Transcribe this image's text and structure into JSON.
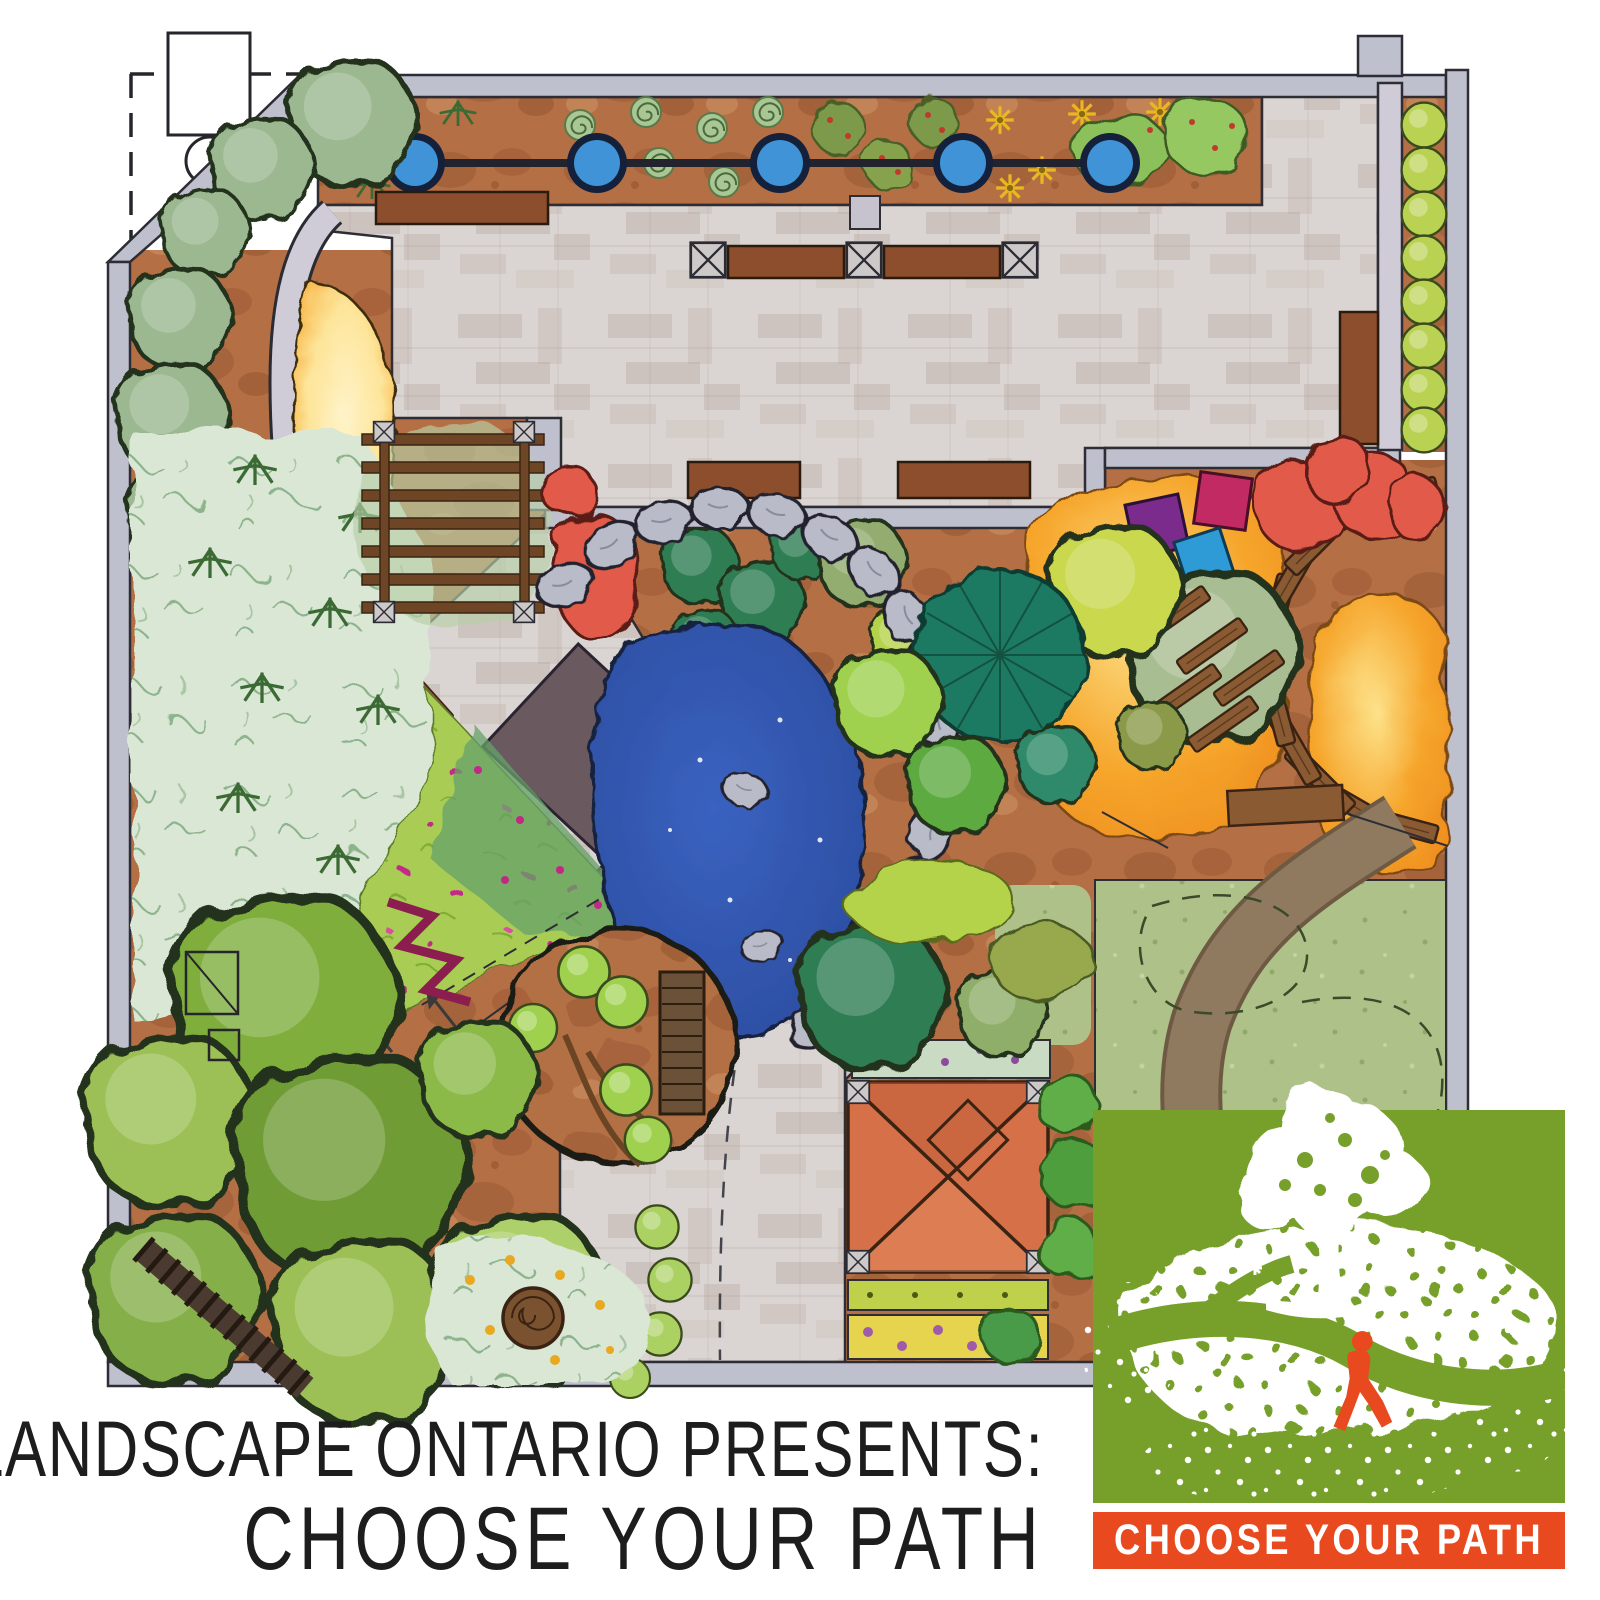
{
  "page": {
    "background": "#ffffff"
  },
  "caption": {
    "line1": "LANDSCAPE ONTARIO PRESENTS:",
    "line2": "CHOOSE YOUR PATH"
  },
  "logo": {
    "label": "CHOOSE YOUR PATH",
    "green": "#76a02a",
    "orange": "#e8491f",
    "white": "#ffffff",
    "tree_icon": "oak-tree",
    "figure_icon": "walking-person"
  },
  "plan": {
    "title": "landscape-master-plan",
    "style": "hand-rendered marker plan view",
    "palette": {
      "outline": "#2e2d35",
      "wall": "#bfc0ce",
      "walkStrip": "#cfccd8",
      "paving": "#dad5d2",
      "pavingBrick": "#c0afa8",
      "soil": "#b46f45",
      "soilShadow": "#8d4f2b",
      "lawn": "#aec189",
      "meadow": "#a9cc55",
      "meadowDark": "#66a268",
      "groundcover": "#d9e7d4",
      "pond": "#2b4c9f",
      "stone": "#b9bbc8",
      "sand": "#f6a62c",
      "sandGlow": "#fde59a",
      "terracotta": "#d57048",
      "bench": "#8c4e2c",
      "pergola": "#6e4626",
      "plank": "#8a5a33",
      "pathBrown": "#8f7a60",
      "redFoliage": "#e25a48",
      "magenta": "#c22987",
      "cushionPurple": "#7a2b8c",
      "cushionCrimson": "#c12a62",
      "cushionBlue": "#2e9bd6",
      "potBlue": "#3f93d6",
      "treeDark": "#2f7d52",
      "treeGreen": "#6fa03c",
      "treeLime": "#9dc258",
      "treeApple": "#8fc94c",
      "ballLime": "#b9d252",
      "conifer": "#1e7a63",
      "sageTree": "#a9bd92",
      "shrub": "#9cb890",
      "chartreuse": "#c9d84e"
    },
    "features": [
      {
        "name": "property-line",
        "color": "#2e2d35"
      },
      {
        "name": "survey-building-footprint",
        "color": "#ffffff"
      },
      {
        "name": "boundary-wall",
        "color": "#bfc0ce"
      },
      {
        "name": "vegetable-garden",
        "color": "#b46f45"
      },
      {
        "name": "container-pots",
        "count": 5,
        "color": "#3f93d6"
      },
      {
        "name": "paved-plaza",
        "color": "#dad5d2"
      },
      {
        "name": "wood-benches",
        "color": "#8c4e2c"
      },
      {
        "name": "pergola-arbor",
        "color": "#6e4626"
      },
      {
        "name": "sand-garden",
        "color": "#f6a62c"
      },
      {
        "name": "evergreen-shrub-border",
        "color": "#9cb890"
      },
      {
        "name": "fern-groundcover",
        "color": "#d9e7d4"
      },
      {
        "name": "perennial-meadow",
        "color": "#a9cc55"
      },
      {
        "name": "pond",
        "color": "#2b4c9f"
      },
      {
        "name": "boulder-edge",
        "color": "#b9bbc8"
      },
      {
        "name": "stepping-slab-walk",
        "color": "#6a5a60"
      },
      {
        "name": "orchard-circle",
        "color": "#8fc94c"
      },
      {
        "name": "shade-tree-grove",
        "color": "#6fa03c"
      },
      {
        "name": "tree-stump",
        "color": "#7b5230"
      },
      {
        "name": "timber-path",
        "color": "#4a3a30"
      },
      {
        "name": "pavilion",
        "color": "#d57048"
      },
      {
        "name": "flower-border-strips",
        "color": "#e6d44e"
      },
      {
        "name": "autumn-garden",
        "color": "#f6a62c"
      },
      {
        "name": "seat-cushions",
        "colors": [
          "#7a2b8c",
          "#c12a62",
          "#2e9bd6"
        ]
      },
      {
        "name": "boardwalk-fan",
        "color": "#8a5a33"
      },
      {
        "name": "conifer-specimen",
        "color": "#1e7a63"
      },
      {
        "name": "open-lawn",
        "color": "#aec189"
      },
      {
        "name": "curved-path",
        "color": "#8f7a60"
      },
      {
        "name": "clipped-hedge-row",
        "color": "#b9d252"
      }
    ]
  }
}
